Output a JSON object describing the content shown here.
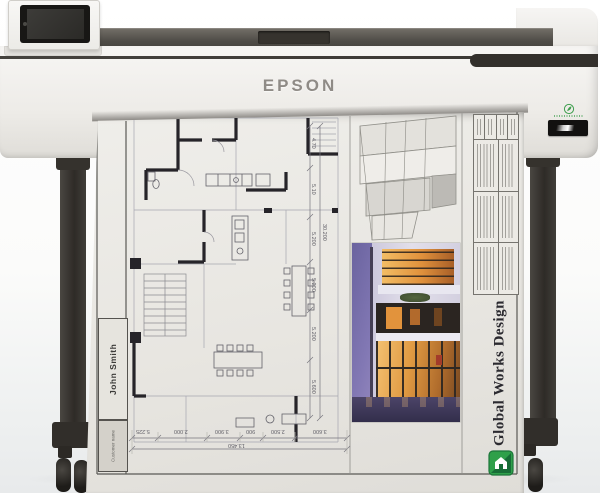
{
  "product": {
    "brand": "EPSON",
    "icons": {
      "eco_badge": "leaf-icon",
      "model_nameplate": "dark-nameplate-badge",
      "touchscreen": "touchscreen-display"
    }
  },
  "printout": {
    "studio": "Global Works Design",
    "customer_name": "John Smith",
    "customer_field_label": "Customer name",
    "logo_icon": "green-house-logo",
    "dimensions": {
      "vertical_chain": [
        "4.70",
        "5.10",
        "5.200",
        "5.200",
        "5.200",
        "5.600"
      ],
      "vertical_total": "30.200",
      "horizontal_chain": [
        "5.225",
        "2.000",
        "3.900",
        "900",
        "2.500",
        "3.600"
      ],
      "horizontal_total": "13.450"
    }
  },
  "colors": {
    "printer_body": "#f3f2ef",
    "printer_top_strip": "#56524c",
    "stand_legs": "#33302b",
    "paper": "#eae8e3",
    "plan_walls": "#262429",
    "plan_thin_lines": "#a6a6b0",
    "photo_sky": "#8a7fb8",
    "window_glow": "#e8a04a",
    "logo_green": "#2f9e45"
  }
}
